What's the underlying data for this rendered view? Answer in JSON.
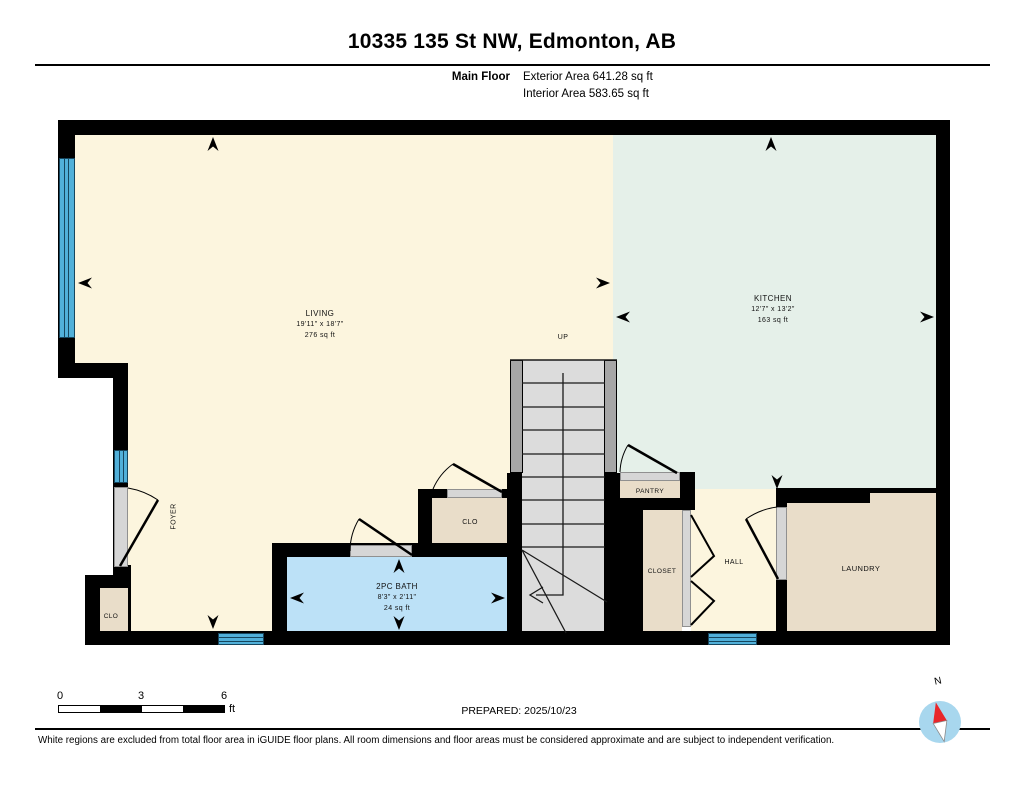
{
  "header": {
    "title": "10335 135 St NW, Edmonton, AB",
    "floor_label": "Main Floor",
    "exterior_area": "Exterior Area 641.28 sq ft",
    "interior_area": "Interior Area 583.65 sq ft"
  },
  "rooms": {
    "living": {
      "label": "LIVING",
      "dims": "19'11\" x 18'7\"",
      "area": "276 sq ft"
    },
    "kitchen": {
      "label": "KITCHEN",
      "dims": "12'7\" x 13'2\"",
      "area": "163 sq ft"
    },
    "bath": {
      "label": "2PC BATH",
      "dims": "8'3\" x 2'11\"",
      "area": "24 sq ft"
    },
    "stairs": {
      "label": "UP"
    },
    "pantry": {
      "label": "PANTRY"
    },
    "closet_mid": {
      "label": "CLO"
    },
    "closet_hall": {
      "label": "CLOSET"
    },
    "hall": {
      "label": "HALL"
    },
    "laundry": {
      "label": "LAUNDRY"
    },
    "foyer": {
      "label": "FOYER"
    },
    "closet_entry": {
      "label": "CLO"
    }
  },
  "scale_bar": {
    "tick_0": "0",
    "tick_3": "3",
    "tick_6": "6",
    "unit": "ft"
  },
  "compass": {
    "label": "N"
  },
  "footer": {
    "prepared": "PREPARED: 2025/10/23",
    "disclaimer": "White regions are excluded from total floor area in iGUIDE floor plans. All room dimensions and floor areas must be considered approximate and are subject to independent verification."
  },
  "colors": {
    "wall": "#000000",
    "living": "#fcf5de",
    "kitchen": "#e5f0e9",
    "closet_tan": "#e9ddc9",
    "bath_blue": "#bce1f7",
    "window_blue": "#51b0d9",
    "stair_tread": "#dcdcdc",
    "stair_stringer": "#a6a6a6",
    "door_opening": "#d6d6d6",
    "compass_blue": "#a8d7ee",
    "compass_red": "#e8262a"
  }
}
